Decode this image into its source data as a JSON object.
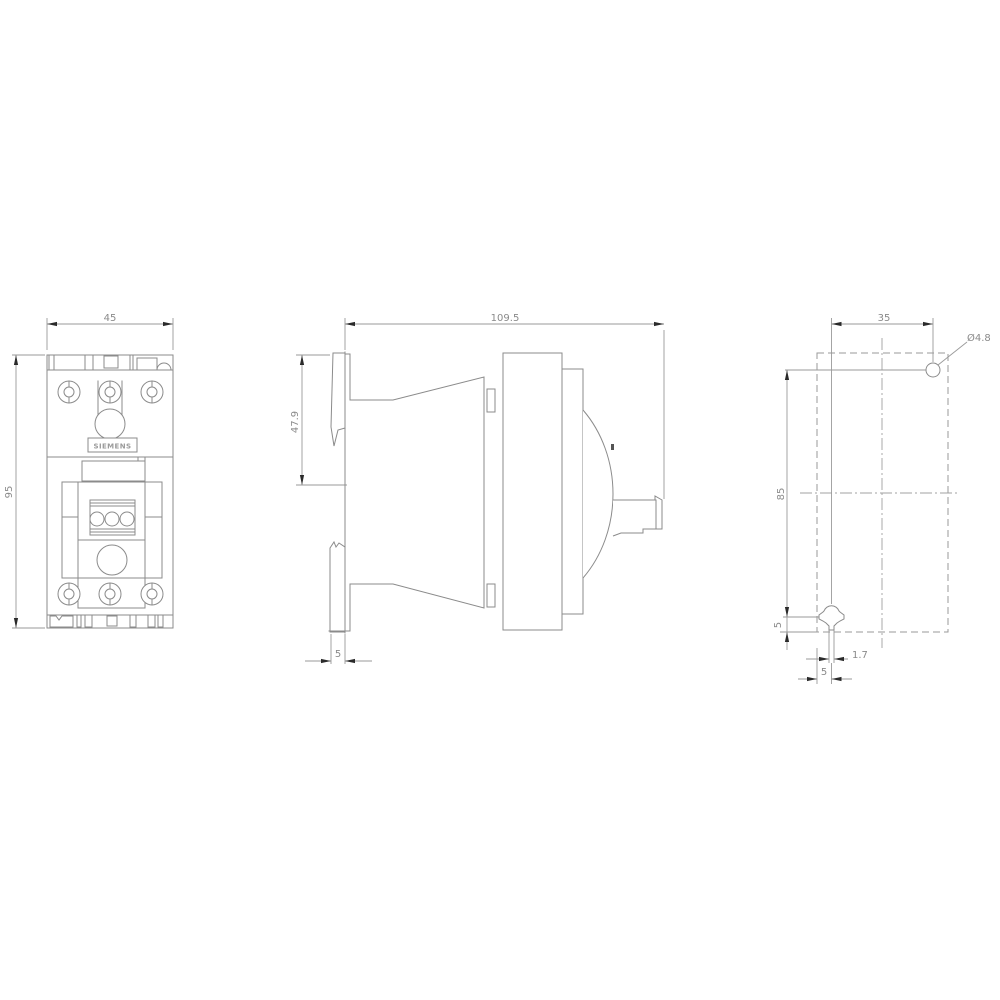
{
  "title": "dimension-drawing",
  "brand": {
    "label": "SIEMENS"
  },
  "colors": {
    "background": "#ffffff",
    "line": "#8b8b8b",
    "dimension_text": "#8a8a8a",
    "arrow": "#2a2a2a"
  },
  "views": {
    "front": {
      "width": "45",
      "height": "95"
    },
    "side": {
      "depth": "109.5",
      "upper_height": "47.9",
      "rail_recess": "5"
    },
    "drill": {
      "hole_spacing_horizontal": "35",
      "hole_diameter": "Ø4.8",
      "hole_spacing_vertical": "85",
      "edge_offset_bottom": "5",
      "slot_width": "1.7",
      "edge_offset_side": "5"
    }
  }
}
